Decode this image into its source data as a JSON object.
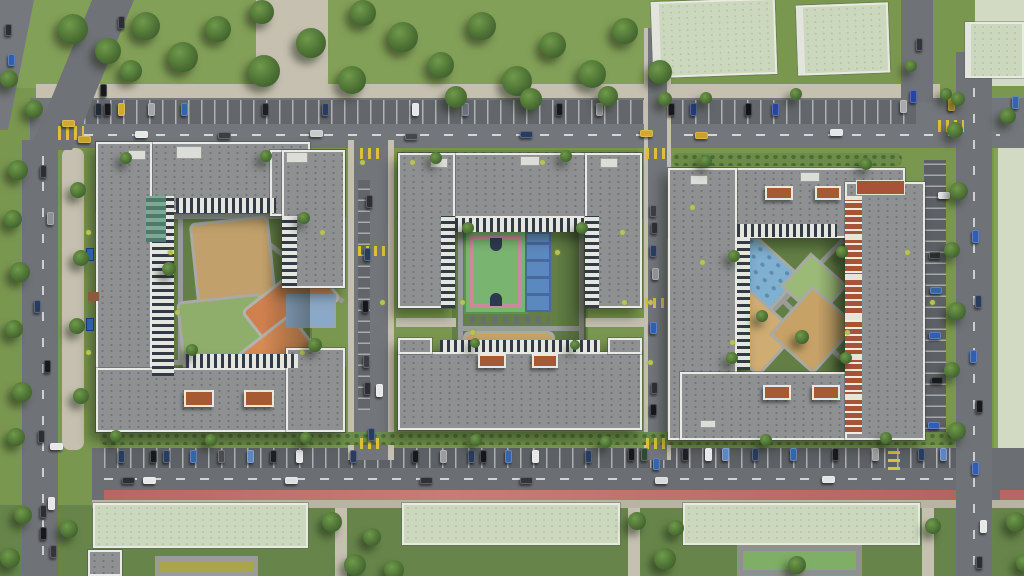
{
  "scene": {
    "type": "aerial-architectural-render",
    "description": "Top-down aerial 3D render of a residential complex: three gray courtyard apartment blocks with sand, orange, green and blue playgrounds, a green-and-pink sports court with a blue court in the middle block, tree-lined parking streets between blocks, a bottom boulevard with parked cars and a red bike lane, pale-green-roofed kindergarten buildings with play courts along the bottom, lawns with trees at the top and sides",
    "colors": {
      "grass": "#7a9750",
      "park_grass": "#83a058",
      "courtyard_lawn": "#637f45",
      "asphalt": "#73767b",
      "parking": "#606368",
      "sidewalk": "#c6c0b0",
      "roof_gray": "#8e9092",
      "parapet_white": "#e9eae6",
      "kindergarten_roof": "#ccd8bd",
      "empty_field": "#d2dac3",
      "red_bike_lane": "#b5685f",
      "crosswalk_yellow": "#d9c23a",
      "play_sand": "#c2a06b",
      "play_orange": "#d0804f",
      "play_green": "#8fae6b",
      "play_blue": "#7fb0d0",
      "court_green": "#79b471",
      "court_pink": "#c98a9b",
      "court_blue": "#5c88c0",
      "court_olive": "#aaa44e",
      "brick_facade": "#a8523a",
      "pergola": "#a65a33",
      "tree_green": "#4a6e33"
    },
    "counts": {
      "residential_blocks": 3,
      "kindergarten_buildings": 3
    }
  },
  "trees": [
    [
      58,
      14,
      30
    ],
    [
      95,
      38,
      26
    ],
    [
      132,
      12,
      28
    ],
    [
      168,
      42,
      30
    ],
    [
      205,
      16,
      26
    ],
    [
      248,
      55,
      32
    ],
    [
      296,
      28,
      30
    ],
    [
      338,
      66,
      28
    ],
    [
      388,
      22,
      30
    ],
    [
      428,
      52,
      26
    ],
    [
      468,
      12,
      28
    ],
    [
      502,
      66,
      30
    ],
    [
      540,
      32,
      26
    ],
    [
      578,
      60,
      28
    ],
    [
      612,
      18,
      26
    ],
    [
      648,
      60,
      24
    ],
    [
      350,
      0,
      26
    ],
    [
      445,
      86,
      22
    ],
    [
      520,
      88,
      22
    ],
    [
      598,
      86,
      20
    ],
    [
      250,
      0,
      24
    ],
    [
      120,
      60,
      22
    ],
    [
      8,
      160,
      20
    ],
    [
      4,
      210,
      18
    ],
    [
      10,
      262,
      20
    ],
    [
      5,
      320,
      18
    ],
    [
      12,
      382,
      20
    ],
    [
      7,
      428,
      18
    ],
    [
      70,
      182,
      16
    ],
    [
      73,
      250,
      16
    ],
    [
      69,
      318,
      16
    ],
    [
      73,
      388,
      16
    ],
    [
      25,
      100,
      18
    ],
    [
      0,
      70,
      18
    ],
    [
      947,
      122,
      16
    ],
    [
      950,
      182,
      18
    ],
    [
      944,
      242,
      16
    ],
    [
      948,
      302,
      18
    ],
    [
      944,
      362,
      16
    ],
    [
      948,
      422,
      18
    ],
    [
      1000,
      108,
      16
    ],
    [
      951,
      92,
      14
    ],
    [
      322,
      512,
      20
    ],
    [
      344,
      554,
      22
    ],
    [
      363,
      528,
      18
    ],
    [
      384,
      560,
      20
    ],
    [
      628,
      512,
      18
    ],
    [
      654,
      548,
      22
    ],
    [
      668,
      520,
      16
    ],
    [
      788,
      556,
      18
    ],
    [
      925,
      518,
      16
    ],
    [
      1006,
      512,
      20
    ],
    [
      1016,
      554,
      18
    ],
    [
      60,
      520,
      18
    ],
    [
      14,
      506,
      18
    ],
    [
      0,
      548,
      20
    ],
    [
      120,
      152,
      12
    ],
    [
      260,
      150,
      12
    ],
    [
      430,
      152,
      12
    ],
    [
      560,
      150,
      12
    ],
    [
      700,
      155,
      12
    ],
    [
      860,
      158,
      12
    ],
    [
      110,
      430,
      12
    ],
    [
      205,
      434,
      12
    ],
    [
      300,
      432,
      12
    ],
    [
      470,
      434,
      12
    ],
    [
      600,
      436,
      12
    ],
    [
      760,
      434,
      12
    ],
    [
      880,
      432,
      12
    ],
    [
      162,
      262,
      14
    ],
    [
      186,
      344,
      12
    ],
    [
      298,
      212,
      12
    ],
    [
      308,
      338,
      14
    ],
    [
      462,
      222,
      12
    ],
    [
      576,
      222,
      12
    ],
    [
      470,
      338,
      10
    ],
    [
      570,
      340,
      10
    ],
    [
      728,
      250,
      12
    ],
    [
      836,
      246,
      12
    ],
    [
      726,
      352,
      12
    ],
    [
      840,
      352,
      12
    ],
    [
      795,
      330,
      14
    ],
    [
      756,
      310,
      12
    ],
    [
      658,
      92,
      14
    ],
    [
      700,
      92,
      12
    ],
    [
      790,
      88,
      12
    ],
    [
      905,
      60,
      12
    ],
    [
      940,
      88,
      12
    ]
  ],
  "bushes": [
    [
      168,
      250
    ],
    [
      175,
      310
    ],
    [
      300,
      350
    ],
    [
      320,
      230
    ],
    [
      460,
      300
    ],
    [
      555,
      250
    ],
    [
      470,
      330
    ],
    [
      620,
      230
    ],
    [
      622,
      300
    ],
    [
      700,
      260
    ],
    [
      840,
      250
    ],
    [
      730,
      340
    ],
    [
      845,
      330
    ],
    [
      360,
      160
    ],
    [
      380,
      300
    ],
    [
      648,
      300
    ],
    [
      648,
      360
    ],
    [
      700,
      160
    ],
    [
      86,
      230
    ],
    [
      86,
      350
    ],
    [
      930,
      300
    ],
    [
      410,
      160
    ],
    [
      540,
      160
    ],
    [
      690,
      205
    ],
    [
      905,
      250
    ]
  ],
  "cars": [
    [
      95,
      103,
      5,
      11,
      "#232a36"
    ],
    [
      104,
      103,
      5,
      11,
      "#15171b"
    ],
    [
      118,
      103,
      5,
      11,
      "#d3a82c"
    ],
    [
      148,
      103,
      5,
      11,
      "#a3a5a7"
    ],
    [
      181,
      103,
      5,
      11,
      "#3465a8"
    ],
    [
      262,
      103,
      5,
      11,
      "#1d1f24"
    ],
    [
      322,
      103,
      5,
      11,
      "#2a3c5e"
    ],
    [
      412,
      103,
      5,
      11,
      "#e6e7e8"
    ],
    [
      462,
      103,
      5,
      11,
      "#6d7480"
    ],
    [
      556,
      103,
      5,
      11,
      "#17191d"
    ],
    [
      596,
      103,
      5,
      11,
      "#9a9c9e"
    ],
    [
      668,
      103,
      5,
      11,
      "#17191d"
    ],
    [
      690,
      103,
      5,
      11,
      "#233d7a"
    ],
    [
      745,
      103,
      5,
      11,
      "#101215"
    ],
    [
      772,
      103,
      5,
      11,
      "#2745a0"
    ],
    [
      900,
      100,
      5,
      11,
      "#a8a9ab"
    ],
    [
      948,
      98,
      5,
      11,
      "#d3a82c"
    ],
    [
      1012,
      96,
      5,
      11,
      "#3465a8"
    ],
    [
      135,
      131,
      11,
      5,
      "#e8e8e8"
    ],
    [
      218,
      132,
      11,
      5,
      "#3b3d42"
    ],
    [
      310,
      130,
      11,
      5,
      "#c9cacb"
    ],
    [
      405,
      133,
      11,
      5,
      "#45474c"
    ],
    [
      520,
      131,
      11,
      5,
      "#2a3c5e"
    ],
    [
      640,
      130,
      11,
      5,
      "#d3a82c"
    ],
    [
      695,
      132,
      11,
      5,
      "#caa026"
    ],
    [
      830,
      129,
      11,
      5,
      "#e4e5e6"
    ],
    [
      62,
      120,
      11,
      5,
      "#d3a82c"
    ],
    [
      78,
      136,
      11,
      5,
      "#c9a22a"
    ],
    [
      118,
      450,
      5,
      11,
      "#2a3c5e"
    ],
    [
      150,
      450,
      5,
      11,
      "#17191d"
    ],
    [
      163,
      450,
      5,
      11,
      "#2a3c5e"
    ],
    [
      190,
      450,
      5,
      11,
      "#3465a8"
    ],
    [
      218,
      450,
      5,
      11,
      "#4a4c50"
    ],
    [
      247,
      450,
      5,
      11,
      "#5d87c2"
    ],
    [
      270,
      450,
      5,
      11,
      "#1d1f24"
    ],
    [
      296,
      450,
      5,
      11,
      "#e6e7e8"
    ],
    [
      350,
      450,
      5,
      11,
      "#2a3c5e"
    ],
    [
      412,
      450,
      5,
      11,
      "#17191d"
    ],
    [
      440,
      450,
      5,
      11,
      "#9a9c9e"
    ],
    [
      468,
      450,
      5,
      11,
      "#2a3c5e"
    ],
    [
      480,
      450,
      5,
      11,
      "#15171b"
    ],
    [
      505,
      450,
      5,
      11,
      "#3465a8"
    ],
    [
      532,
      450,
      5,
      11,
      "#e6e7e8"
    ],
    [
      585,
      450,
      5,
      11,
      "#2a3c5e"
    ],
    [
      628,
      448,
      5,
      11,
      "#15171b"
    ],
    [
      641,
      448,
      5,
      11,
      "#2e4a32"
    ],
    [
      682,
      448,
      5,
      11,
      "#1d1f24"
    ],
    [
      705,
      448,
      5,
      11,
      "#e6e7e8"
    ],
    [
      722,
      448,
      5,
      11,
      "#5d87c2"
    ],
    [
      752,
      448,
      5,
      11,
      "#2a3c5e"
    ],
    [
      790,
      448,
      5,
      11,
      "#3465a8"
    ],
    [
      832,
      448,
      5,
      11,
      "#17191d"
    ],
    [
      872,
      448,
      5,
      11,
      "#9a9c9e"
    ],
    [
      918,
      448,
      5,
      11,
      "#2a3c5e"
    ],
    [
      940,
      448,
      5,
      11,
      "#5d87c2"
    ],
    [
      122,
      477,
      11,
      5,
      "#2c2e33"
    ],
    [
      143,
      477,
      11,
      5,
      "#e8e8e8"
    ],
    [
      285,
      477,
      11,
      5,
      "#dfe0e1"
    ],
    [
      420,
      477,
      11,
      5,
      "#2f3136"
    ],
    [
      520,
      477,
      11,
      5,
      "#33353a"
    ],
    [
      655,
      477,
      11,
      5,
      "#d9dadb"
    ],
    [
      822,
      476,
      11,
      5,
      "#e4e4e4"
    ],
    [
      40,
      165,
      5,
      11,
      "#2c2e33"
    ],
    [
      47,
      212,
      5,
      11,
      "#8f9193"
    ],
    [
      34,
      300,
      5,
      11,
      "#2a3c5e"
    ],
    [
      44,
      360,
      5,
      11,
      "#17191d"
    ],
    [
      38,
      430,
      5,
      11,
      "#2c2e33"
    ],
    [
      50,
      443,
      11,
      5,
      "#e8e8e8"
    ],
    [
      48,
      497,
      5,
      11,
      "#e6e7e8"
    ],
    [
      40,
      505,
      5,
      11,
      "#2c2e33"
    ],
    [
      40,
      527,
      5,
      11,
      "#17191d"
    ],
    [
      50,
      545,
      5,
      11,
      "#33353a"
    ],
    [
      118,
      16,
      5,
      11,
      "#2c2e33"
    ],
    [
      110,
      46,
      5,
      11,
      "#8f9193"
    ],
    [
      100,
      84,
      5,
      11,
      "#17191d"
    ],
    [
      5,
      24,
      5,
      10,
      "#2c2e33"
    ],
    [
      8,
      54,
      5,
      10,
      "#2f5fb0"
    ],
    [
      910,
      90,
      5,
      11,
      "#2745a0"
    ],
    [
      916,
      38,
      5,
      11,
      "#33353a"
    ],
    [
      972,
      230,
      5,
      11,
      "#2f5fb0"
    ],
    [
      975,
      295,
      5,
      11,
      "#2a3c5e"
    ],
    [
      970,
      350,
      5,
      11,
      "#2f5fb0"
    ],
    [
      976,
      400,
      5,
      11,
      "#17191d"
    ],
    [
      972,
      462,
      5,
      11,
      "#2f5fb0"
    ],
    [
      980,
      520,
      5,
      11,
      "#e8e8e8"
    ],
    [
      976,
      556,
      5,
      11,
      "#2c2e33"
    ],
    [
      938,
      192,
      10,
      5,
      "#e6e7e8"
    ],
    [
      929,
      252,
      10,
      5,
      "#2c2e33"
    ],
    [
      930,
      287,
      10,
      5,
      "#3465a8"
    ],
    [
      929,
      332,
      10,
      5,
      "#2f5fb0"
    ],
    [
      931,
      377,
      10,
      5,
      "#17191d"
    ],
    [
      928,
      422,
      10,
      5,
      "#2f5fb0"
    ],
    [
      366,
      195,
      5,
      11,
      "#2c2e33"
    ],
    [
      364,
      248,
      5,
      11,
      "#2a3c5e"
    ],
    [
      362,
      300,
      5,
      11,
      "#15171b"
    ],
    [
      363,
      355,
      5,
      11,
      "#3b3d42"
    ],
    [
      364,
      382,
      5,
      11,
      "#2c2e33"
    ],
    [
      376,
      384,
      5,
      11,
      "#e8e8e8"
    ],
    [
      368,
      428,
      5,
      11,
      "#2a3c5e"
    ],
    [
      650,
      205,
      5,
      10,
      "#3b3d42"
    ],
    [
      651,
      222,
      5,
      10,
      "#2c2e33"
    ],
    [
      650,
      245,
      5,
      10,
      "#2a3c5e"
    ],
    [
      652,
      268,
      5,
      10,
      "#8f9193"
    ],
    [
      650,
      322,
      5,
      10,
      "#2f5fb0"
    ],
    [
      651,
      382,
      5,
      10,
      "#2c2e33"
    ],
    [
      650,
      404,
      5,
      10,
      "#15171b"
    ],
    [
      653,
      458,
      5,
      10,
      "#3465a8"
    ]
  ]
}
